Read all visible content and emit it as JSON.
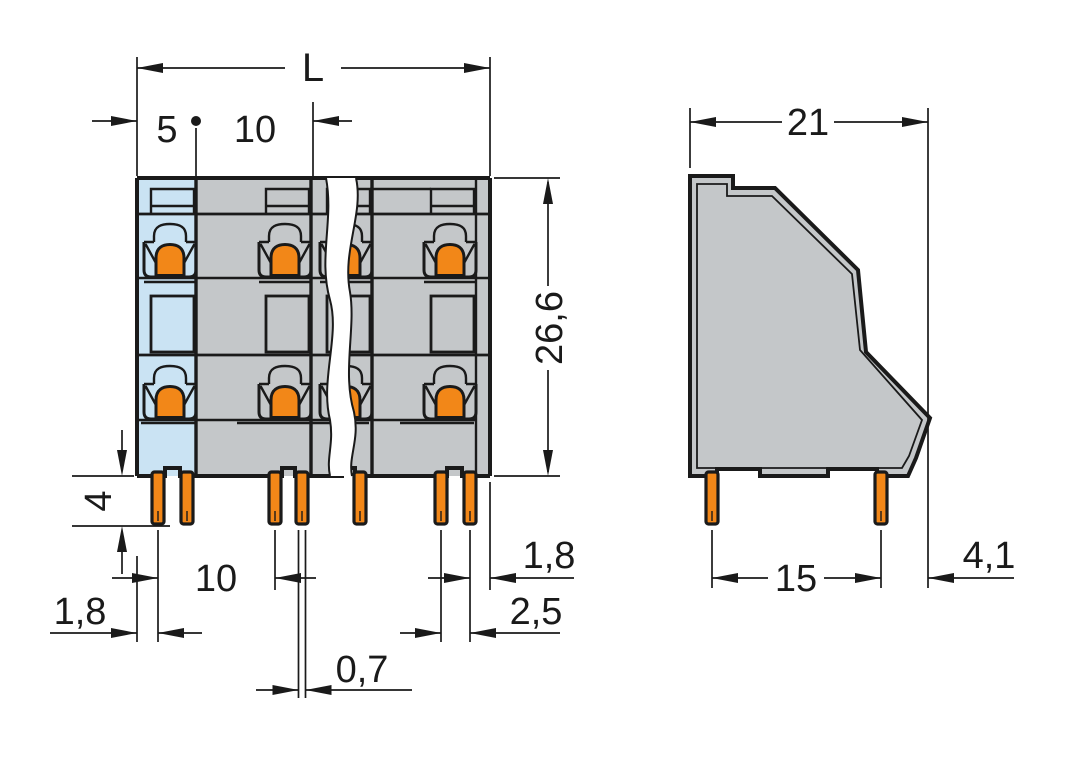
{
  "colors": {
    "line": "#1a1a1a",
    "body": "#c4c7c9",
    "highlight": "#cae3f3",
    "actuator": "#f28718",
    "background": "#ffffff"
  },
  "front_view": {
    "top": {
      "overall_width": "L",
      "edge_to_center": "5",
      "pitch": "10"
    },
    "side": {
      "height": "26,6"
    },
    "left": {
      "pin_length": "4"
    },
    "bottom": {
      "pin_pitch": "10",
      "left_edge_to_pin": "1,8",
      "pin_to_right_edge": "1,8",
      "pin_row_offset": "2,5",
      "pin_thickness": "0,7"
    }
  },
  "side_view": {
    "depth": "21",
    "pin_spacing": "15",
    "rear_offset": "4,1"
  }
}
